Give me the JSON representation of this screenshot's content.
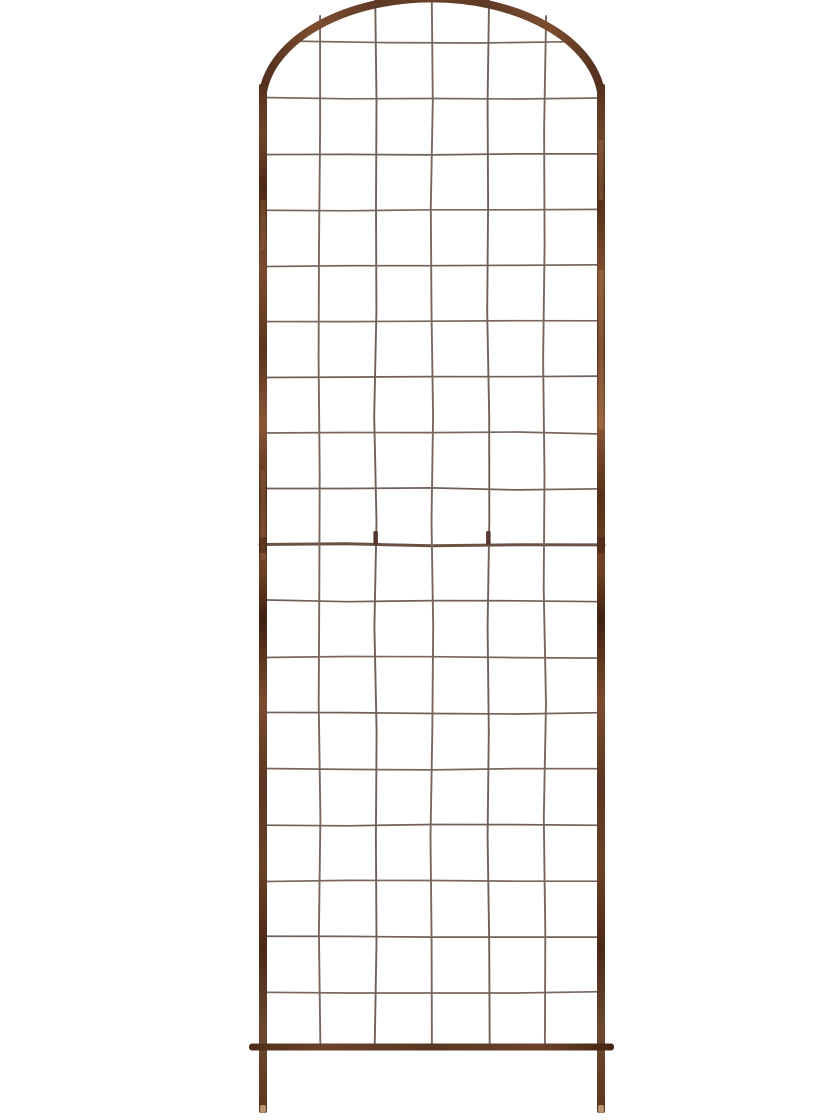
{
  "page": {
    "background_color": "#ffffff"
  },
  "photo": {
    "subject": "Arched rust-brown metal grid garden trellis product photo",
    "background": "plain white"
  },
  "trellis": {
    "colors": {
      "frame_dark": "#3f2212",
      "frame_base": "#5d3926",
      "frame_mid": "#6b4128",
      "frame_highlight": "#8a5637",
      "frame_copper": "#b07e52",
      "wire": "#6e5b51",
      "wire_alt": "#655349",
      "joint_wire": "#5e4536",
      "tab": "#46281c",
      "leg_tip": "#c09c74",
      "rust_band_dark": "#3a2013"
    },
    "layout": {
      "canvas_w": 840,
      "canvas_h": 1120,
      "rail_left_x": 263,
      "rail_right_x": 601,
      "rail_top_y": 84,
      "rail_width": 8,
      "arch_rx": 170,
      "arch_ry": 105,
      "arch_base_y": 92,
      "arch_stroke": 8,
      "grid_top_row_y": 42,
      "row_spacing": 55.9,
      "row_count": 18,
      "joint_row_index": 9,
      "inner_columns_x": [
        319.3,
        375.7,
        432,
        488.3,
        544.7
      ],
      "columns_cut_at_top": [
        false,
        true,
        true,
        true,
        false
      ],
      "column_arch_top_y": 16,
      "wire_width": 1.7,
      "vwire_width": 1.9,
      "joint_wire_width": 3,
      "arch_row_x1": 292,
      "arch_row_x2": 572,
      "bottom_bar_y": 1047,
      "bottom_bar_x1": 249,
      "bottom_bar_x2": 614,
      "bottom_bar_h": 7,
      "leg_bottom_y": 1113,
      "leg_tip_h": 8,
      "tab_columns_x": [
        375.7,
        488.3
      ],
      "tab_w": 4.5,
      "tab_h": 14
    },
    "structure": {
      "grid_columns": 6,
      "grid_rows": 18,
      "panels": 2,
      "legs": 2,
      "top_shape": "arch (apex cropped by image top edge)"
    }
  }
}
